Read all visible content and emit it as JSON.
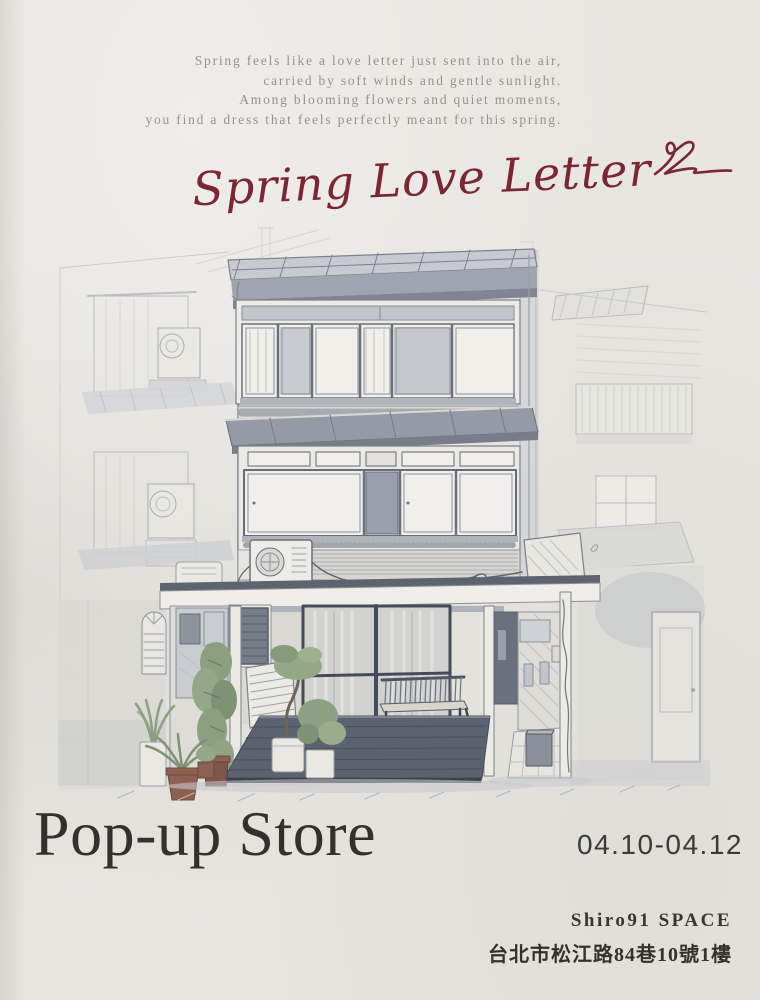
{
  "poster": {
    "paper_color": "#e8e6e1",
    "accent_color": "#7b2733",
    "text_color": "#33312d",
    "muted_text_color": "#9a8f8b"
  },
  "intro": {
    "lines": [
      "Spring feels like a love letter just sent into the air,",
      "carried by soft winds and gentle sunlight.",
      "Among blooming flowers and quiet moments,",
      "you find a dress that feels perfectly meant for this spring."
    ]
  },
  "title": {
    "text": "Spring Love Letter"
  },
  "event": {
    "label": "Pop-up Store",
    "dates": "04.10-04.12",
    "venue": "Shiro91 SPACE",
    "address": "台北市松江路84巷10號1樓"
  },
  "illustration": {
    "description": "Hand-drawn watercolor sketch of a three-storey shophouse with rooftop canopy, window bands, awnings, an open storefront with dark wooden deck, glass sliding doors, a slatted bench, potted plants, a side alley, and faint neighboring buildings",
    "palette": {
      "line": "#7b818c",
      "wash": "#c7cad0",
      "deck": "#5a636f",
      "plant": "#8ba07f",
      "terracotta_pot": "#8e6051"
    }
  }
}
